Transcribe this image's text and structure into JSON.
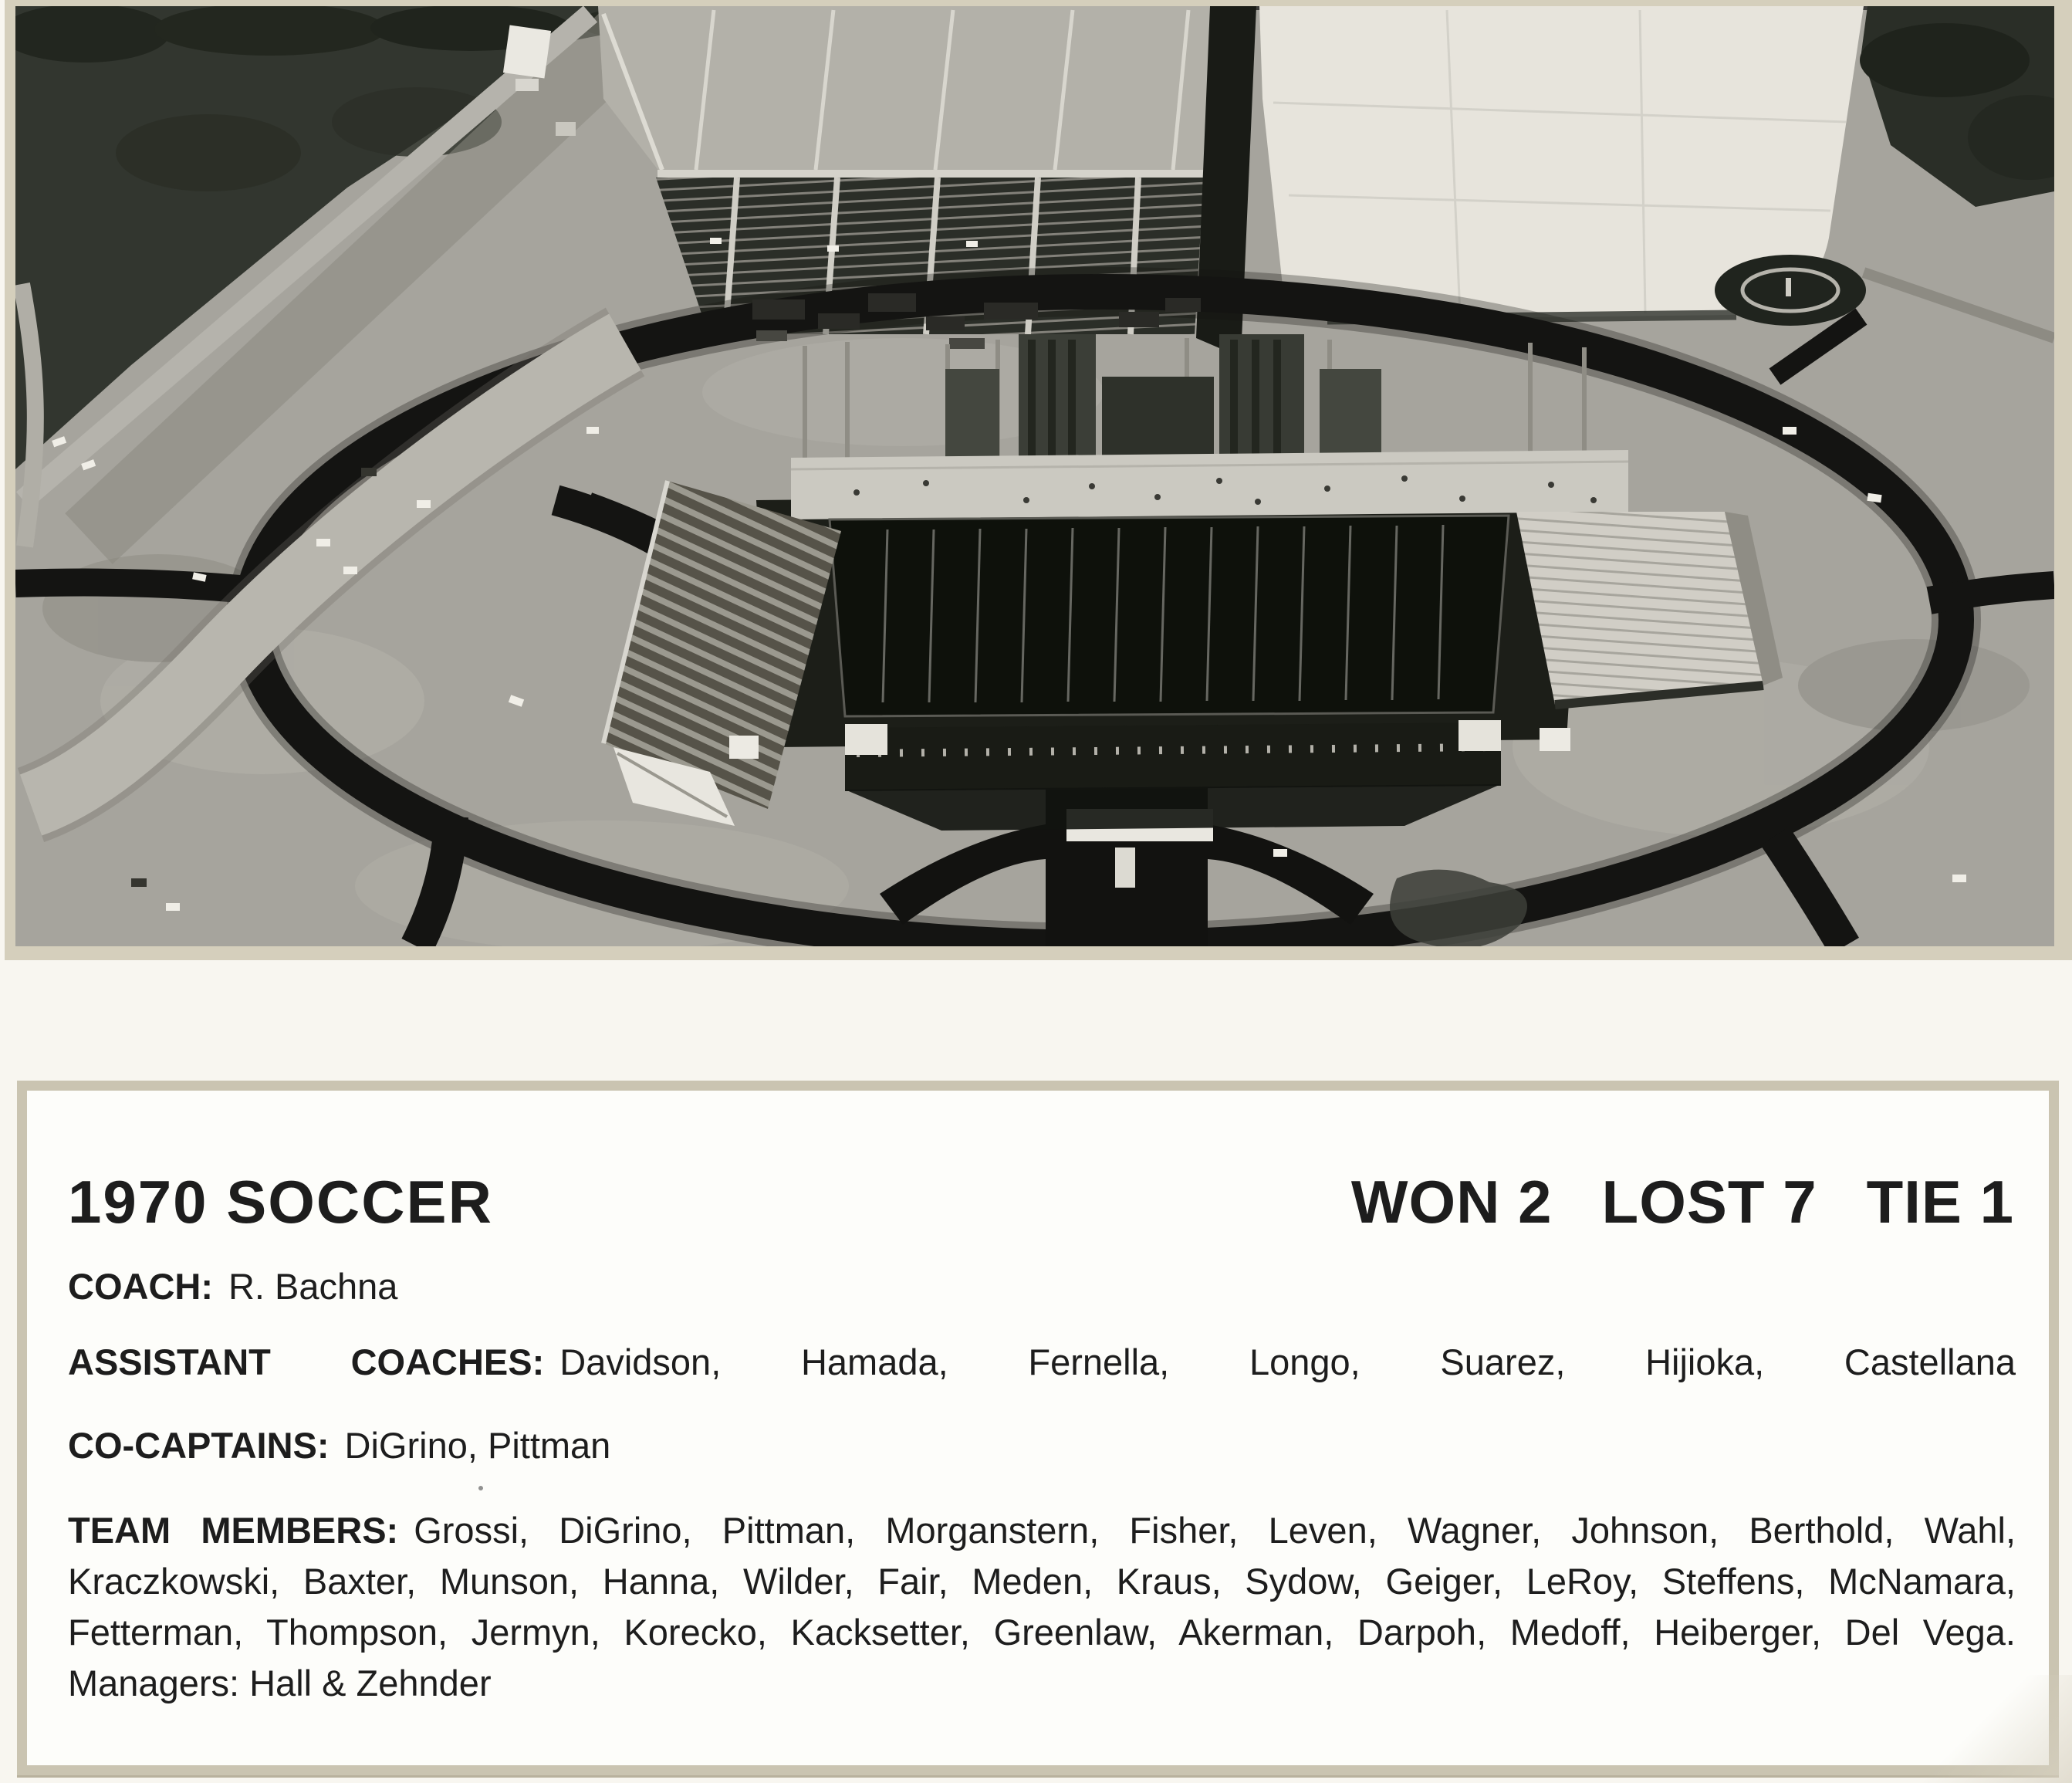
{
  "photo": {
    "description": "black-and-white aerial photograph of a stadium under construction with oval ring road and parking lots",
    "palette": {
      "dirt": "#a6a49d",
      "dark_asphalt": "#141412",
      "vegetation": "#32362f",
      "parking_rows": "#2b2e28",
      "plaza": "#e7e4dc",
      "field": "#0e110b",
      "light_road": "#b8b6ae",
      "roofs": "#e9e7e0"
    }
  },
  "card": {
    "title": "1970 SOCCER",
    "record": {
      "won": "WON 2",
      "lost": "LOST 7",
      "tie": "TIE 1"
    },
    "coach": {
      "label": "COACH:",
      "value": "R. Bachna"
    },
    "assistant_coaches": {
      "label": "ASSISTANT COACHES:",
      "value": "Davidson, Hamada, Fernella, Longo, Suarez, Hijioka, Castellana"
    },
    "co_captains": {
      "label": "CO-CAPTAINS:",
      "value": "DiGrino, Pittman"
    },
    "team_members": {
      "label": "TEAM MEMBERS:",
      "value": "Grossi, DiGrino, Pittman, Morganstern, Fisher, Leven, Wagner, Johnson, Berthold, Wahl, Kraczkowski, Baxter, Munson, Hanna, Wilder, Fair, Meden, Kraus, Sydow, Geiger, LeRoy, Steffens, McNamara, Fetterman, Thompson, Jermyn, Korecko, Kacksetter, Greenlaw, Akerman, Darpoh, Medoff, Heiberger, Del Vega. Managers: Hall & Zehnder"
    }
  },
  "colors": {
    "page_bg": "#f8f6f0",
    "photo_mat": "#d5cfbc",
    "card_border": "#cac4b1",
    "card_bg": "#fdfdfa",
    "text": "#1d1d1d"
  }
}
